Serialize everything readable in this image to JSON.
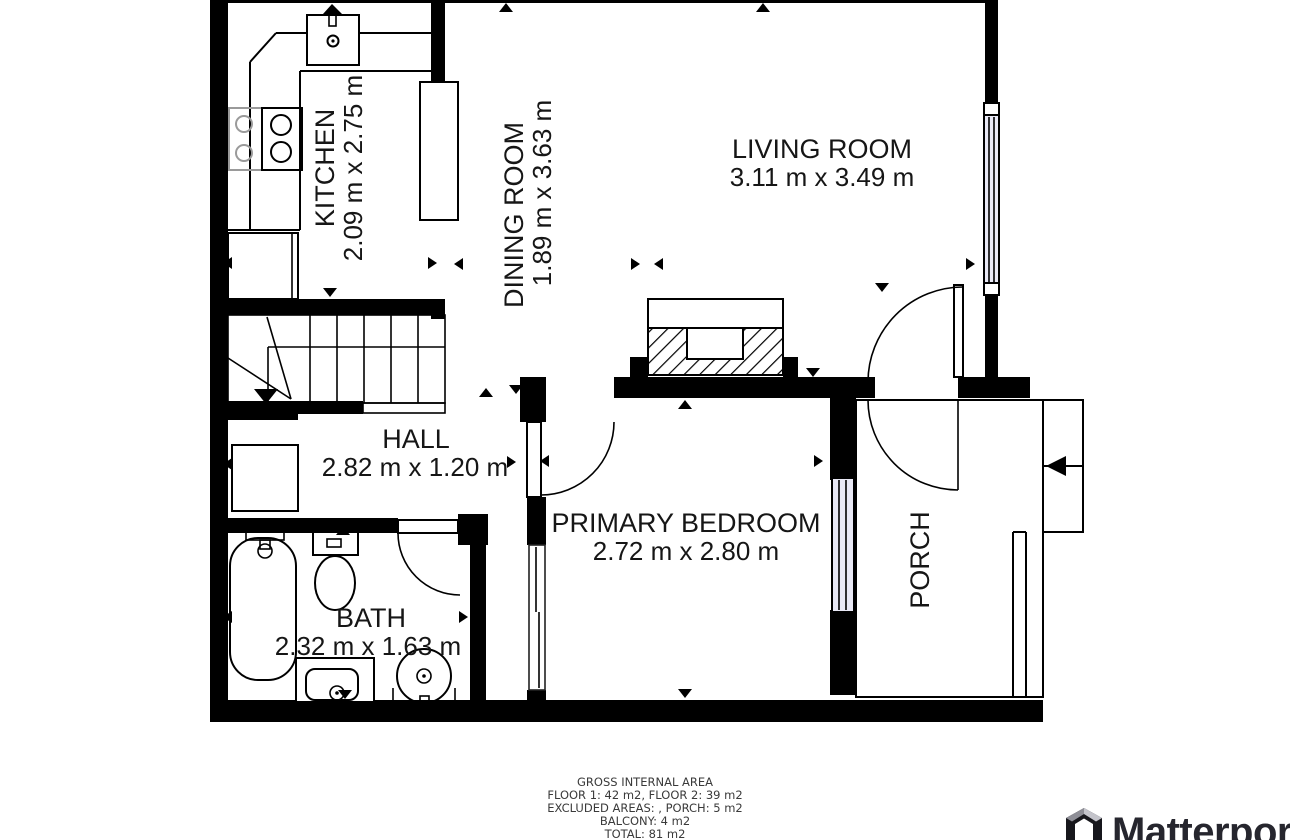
{
  "floorplan": {
    "rooms": {
      "kitchen": {
        "name": "KITCHEN",
        "dims": "2.09 m x 2.75 m"
      },
      "dining": {
        "name": "DINING ROOM",
        "dims": "1.89 m x 3.63 m"
      },
      "living": {
        "name": "LIVING ROOM",
        "dims": "3.11 m x 3.49 m"
      },
      "hall": {
        "name": "HALL",
        "dims": "2.82 m x 1.20 m"
      },
      "bedroom": {
        "name": "PRIMARY BEDROOM",
        "dims": "2.72 m x 2.80 m"
      },
      "bath": {
        "name": "BATH",
        "dims": "2.32 m x 1.63 m"
      },
      "porch": {
        "name": "PORCH"
      }
    },
    "footer": {
      "line1": "GROSS INTERNAL AREA",
      "line2": "FLOOR 1: 42 m2, FLOOR 2: 39 m2",
      "line3": "EXCLUDED AREAS: , PORCH: 5 m2",
      "line4": "BALCONY: 4 m2",
      "line5": "TOTAL: 81 m2"
    },
    "branding": {
      "logo_text": "Matterport"
    },
    "colors": {
      "wall": "#000000",
      "window_fill": "#e9e9f6",
      "footer_text": "#3a3a3a",
      "logo_text": "#26262e"
    }
  }
}
